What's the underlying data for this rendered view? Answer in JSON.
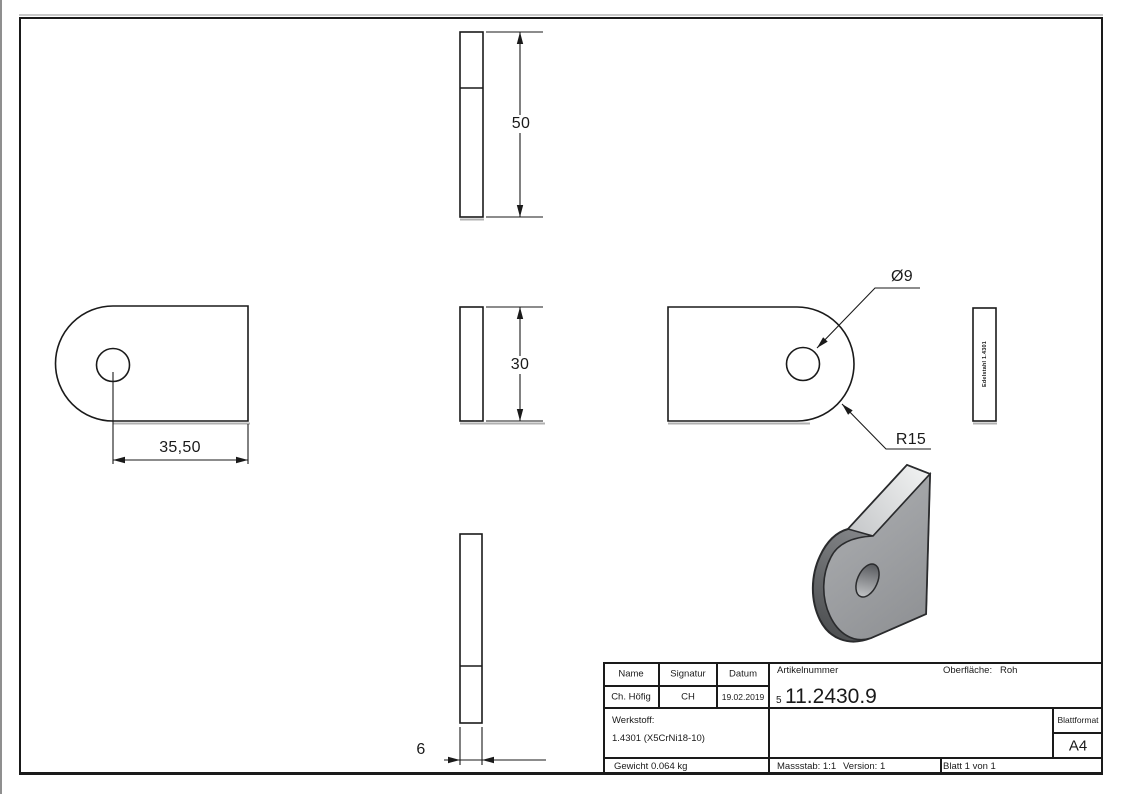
{
  "dimensions": {
    "side_height": "50",
    "front_height": "30",
    "hole_to_edge": "35,50",
    "thickness": "6",
    "hole_diameter": "Ø9",
    "corner_radius": "R15"
  },
  "marking": {
    "vertical_text": "Edelstahl 1.4301"
  },
  "title_block": {
    "col_name": "Name",
    "col_signatur": "Signatur",
    "col_datum": "Datum",
    "name": "Ch. Höfig",
    "signatur": "CH",
    "datum": "19.02.2019",
    "artikelnummer_label": "Artikelnummer",
    "artikelnummer_prefix": "5",
    "artikelnummer": "11.2430.9",
    "oberflaeche_label": "Oberfläche:",
    "oberflaeche_value": "Roh",
    "werkstoff_label": "Werkstoff:",
    "werkstoff_value": "1.4301 (X5CrNi18-10)",
    "blattformat_label": "Blattformat",
    "blattformat_value": "A4",
    "gewicht": "Gewicht 0.064 kg",
    "massstab": "Massstab: 1:1",
    "version": "Version: 1",
    "blatt": "Blatt 1 von 1"
  },
  "colors": {
    "line": "#1a1a1a",
    "shadow_line": "#b0b0b0",
    "face_mid": "#97999c",
    "face_light": "#eceded",
    "face_dark": "#4e5052"
  }
}
